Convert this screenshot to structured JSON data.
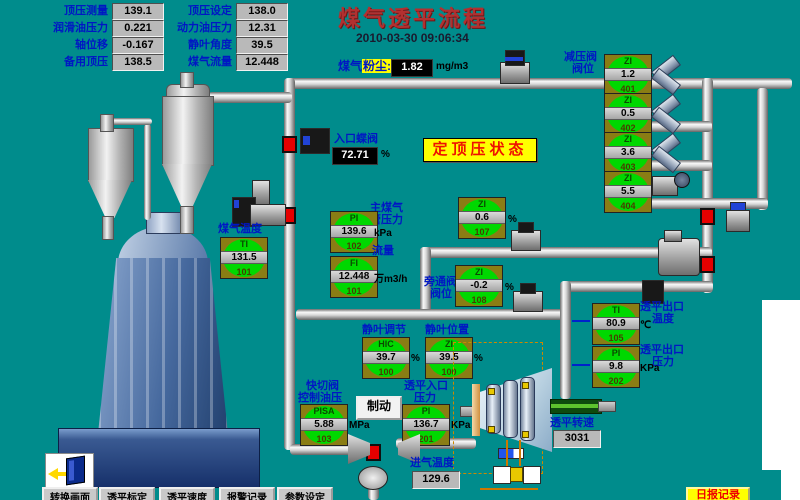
{
  "app": {
    "title": "煤气透平流程",
    "datetime": "2010-03-30 09:06:34",
    "banner": "定顶压状态"
  },
  "panel": {
    "rows": [
      {
        "l1": "顶压测量",
        "v1": "139.1",
        "l2": "顶压设定",
        "v2": "138.0"
      },
      {
        "l1": "润滑油压力",
        "v1": "0.221",
        "l2": "动力油压力",
        "v2": "12.31"
      },
      {
        "l1": "轴位移",
        "v1": "-0.167",
        "l2": "静叶角度",
        "v2": "39.5"
      },
      {
        "l1": "备用顶压",
        "v1": "138.5",
        "l2": "煤气流量",
        "v2": "12.448"
      }
    ]
  },
  "dust": {
    "label_a": "煤气",
    "label_b": "粉尘:",
    "value": "1.82",
    "unit": "mg/m3"
  },
  "inlet_valve": {
    "label": "入口蝶阀",
    "value": "72.71",
    "unit": "%"
  },
  "reducer_valve_label": {
    "line1": "减压阀",
    "line2": "阀位"
  },
  "gauges": [
    {
      "type": "ZI",
      "value": "1.2",
      "tag": "401",
      "unit": "",
      "label1": "",
      "label2": ""
    },
    {
      "type": "ZI",
      "value": "0.5",
      "tag": "402",
      "unit": "",
      "label1": "",
      "label2": ""
    },
    {
      "type": "ZI",
      "value": "3.6",
      "tag": "403",
      "unit": "",
      "label1": "",
      "label2": ""
    },
    {
      "type": "ZI",
      "value": "5.5",
      "tag": "404",
      "unit": "",
      "label1": "",
      "label2": ""
    },
    {
      "type": "PI",
      "value": "139.6",
      "tag": "102",
      "unit": "kPa",
      "label1": "主煤气",
      "label2": "管压力"
    },
    {
      "type": "FI",
      "value": "12.448",
      "tag": "101",
      "unit": "万m3/h",
      "label1": "流量",
      "label2": ""
    },
    {
      "type": "TI",
      "value": "131.5",
      "tag": "101",
      "unit": "",
      "label1": "煤气温度",
      "label2": ""
    },
    {
      "type": "ZI",
      "value": "0.6",
      "tag": "107",
      "unit": "%",
      "label1": "",
      "label2": ""
    },
    {
      "type": "ZI",
      "value": "-0.2",
      "tag": "108",
      "unit": "%",
      "label1": "旁通阀",
      "label2": "阀位"
    },
    {
      "type": "TI",
      "value": "80.9",
      "tag": "105",
      "unit": "℃",
      "label1": "透平出口",
      "label2": "温度"
    },
    {
      "type": "PI",
      "value": "9.8",
      "tag": "202",
      "unit": "KPa",
      "label1": "透平出口",
      "label2": "压力"
    },
    {
      "type": "HIC",
      "value": "39.7",
      "tag": "100",
      "unit": "%",
      "label1": "静叶调节",
      "label2": ""
    },
    {
      "type": "ZI",
      "value": "39.5",
      "tag": "100",
      "unit": "%",
      "label1": "静叶位置",
      "label2": ""
    },
    {
      "type": "PISA",
      "value": "5.88",
      "tag": "103",
      "unit": "MPa",
      "label1": "快切阀",
      "label2": "控制油压"
    },
    {
      "type": "PI",
      "value": "136.7",
      "tag": "201",
      "unit": "KPa",
      "label1": "透平入口",
      "label2": "压力"
    }
  ],
  "displays": {
    "intake_temp": {
      "label": "进气温度",
      "value": "129.6"
    },
    "speed": {
      "label": "透平转速",
      "value": "3031"
    }
  },
  "buttons": {
    "brake": "制动",
    "report": "日报记录",
    "bottom": [
      "转换画面",
      "透平标定",
      "透平速度",
      "报警记录",
      "参数设定"
    ]
  }
}
